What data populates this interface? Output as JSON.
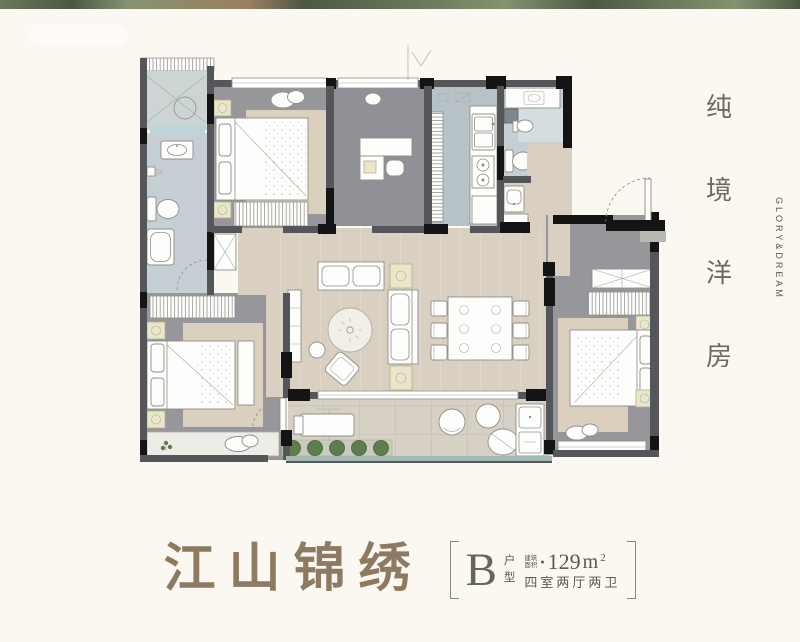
{
  "page": {
    "width": 800,
    "height": 642,
    "background": "#fbf7f1"
  },
  "photo_strip": {
    "note": "green tree-line photo edge at very top"
  },
  "sidebar": {
    "title": "纯境洋房",
    "chars": [
      "纯",
      "境",
      "洋",
      "房"
    ],
    "subtitle": "GLORY&DREAM"
  },
  "footer": {
    "project_name": "江山锦绣",
    "unit_letter": "B",
    "unit_word_top": "户",
    "unit_word_bottom": "型",
    "area_prefix_top": "建筑",
    "area_prefix_bottom": "面积",
    "bullet": "●",
    "area_number": "129",
    "area_unit": "m",
    "area_sup": "2",
    "layout_desc": "四室两厅两卫"
  },
  "palette": {
    "bg": "#fbf7f1",
    "wall_gray": "#54565a",
    "wall_black": "#141414",
    "floor_wood": "#d9d0c1",
    "floor_gray": "#97979b",
    "floor_study": "#8f9196",
    "floor_rug": "#dbcfbd",
    "floor_kitchen": "#b7c1c8",
    "floor_bath": "#c6d0d4",
    "floor_bath_lt": "#d4dee1",
    "floor_laundry": "#ccd4d4",
    "floor_balcony": "#d7d1c5",
    "sill_blue": "#bdd4d8",
    "furn_white": "#fdfdfc",
    "furn_stroke": "#8e8e8a",
    "accent_yellow": "#eae7c9",
    "plant_green": "#5e7c4e",
    "plant_bed": "#c9ccbc",
    "rail_teal": "#a3bab5",
    "text_title": "#8d7a61",
    "text_dark": "#5f594d",
    "text_side": "#6e6960",
    "text_en": "#5d574b",
    "strip_a": "#4f6140",
    "strip_b": "#2f3b27",
    "strip_c": "#71815a",
    "strip_d": "#8a6a46"
  }
}
